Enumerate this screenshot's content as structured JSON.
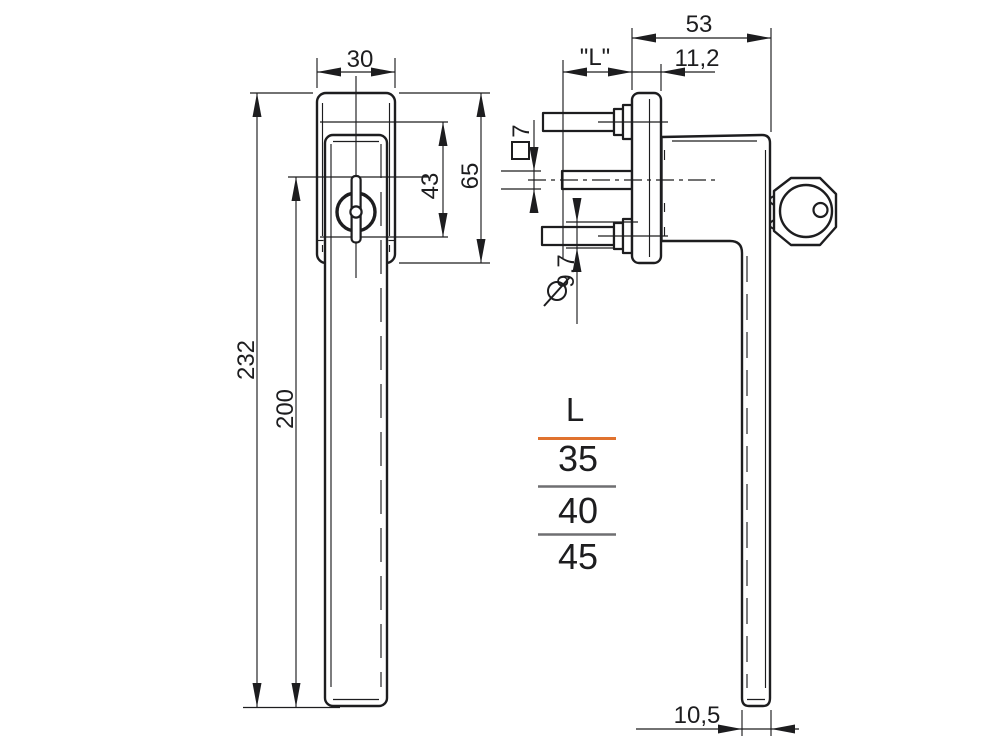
{
  "front_view": {
    "grip_width": "30",
    "total_length": "232",
    "lever_length": "200",
    "screw_spacing": "43",
    "rosette_height": "65"
  },
  "side_view": {
    "depth": "53",
    "spindle_length": "\"L\"",
    "flange_offset": "11,2",
    "spindle_square": "7",
    "screw_diameter": "9,7",
    "lever_thickness": "10,5"
  },
  "size_table": {
    "header": "L",
    "sizes": [
      "35",
      "40",
      "45"
    ]
  },
  "colors": {
    "line": "#1d1d1f",
    "accent": "#e0722e",
    "divider": "#6f6f71"
  }
}
